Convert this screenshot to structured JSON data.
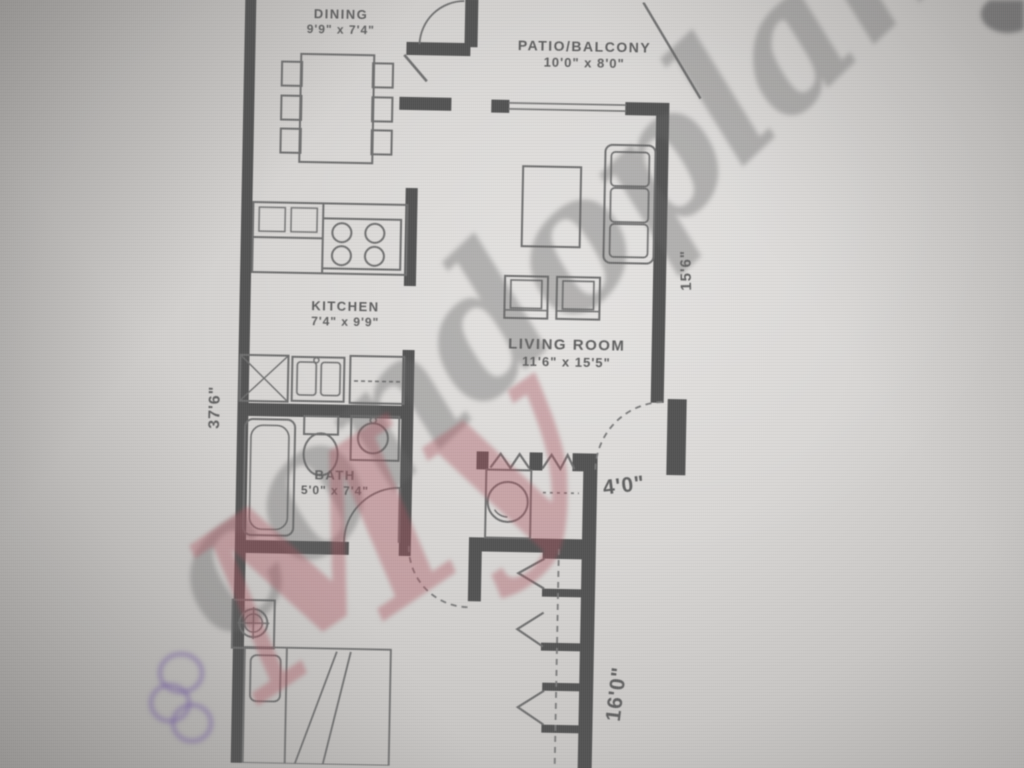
{
  "rooms": [
    {
      "name": "dining",
      "label": "DINING",
      "size": "9'9\" x 7'4\""
    },
    {
      "name": "patio-balcony",
      "label": "PATIO/BALCONY",
      "size": "10'0\" x 8'0\""
    },
    {
      "name": "kitchen",
      "label": "KITCHEN",
      "size": "7'4\" x 9'9\""
    },
    {
      "name": "living-room",
      "label": "LIVING ROOM",
      "size": "11'6\" x 15'5\""
    },
    {
      "name": "bath",
      "label": "BATH",
      "size": "5'0\" x 7'4\""
    }
  ],
  "dimensions": [
    {
      "name": "overall-left-depth",
      "text": "37'6\""
    },
    {
      "name": "living-room-depth",
      "text": "15'6\""
    },
    {
      "name": "entry-closet-width",
      "text": "4'0\""
    },
    {
      "name": "hall-closet-run",
      "text": "16'0\""
    }
  ],
  "watermark": {
    "prefix": "My",
    "suffix": "condoplans",
    "prefix_color": "#aa565e",
    "suffix_color": "#646464",
    "accent_color": "#7a68a0"
  },
  "colors": {
    "wall": "#545454",
    "thin_line": "#6f6f6f",
    "label_text": "#5f5f5f",
    "paper_light": "#e0dedc",
    "paper_dark": "#a9a7a5"
  }
}
